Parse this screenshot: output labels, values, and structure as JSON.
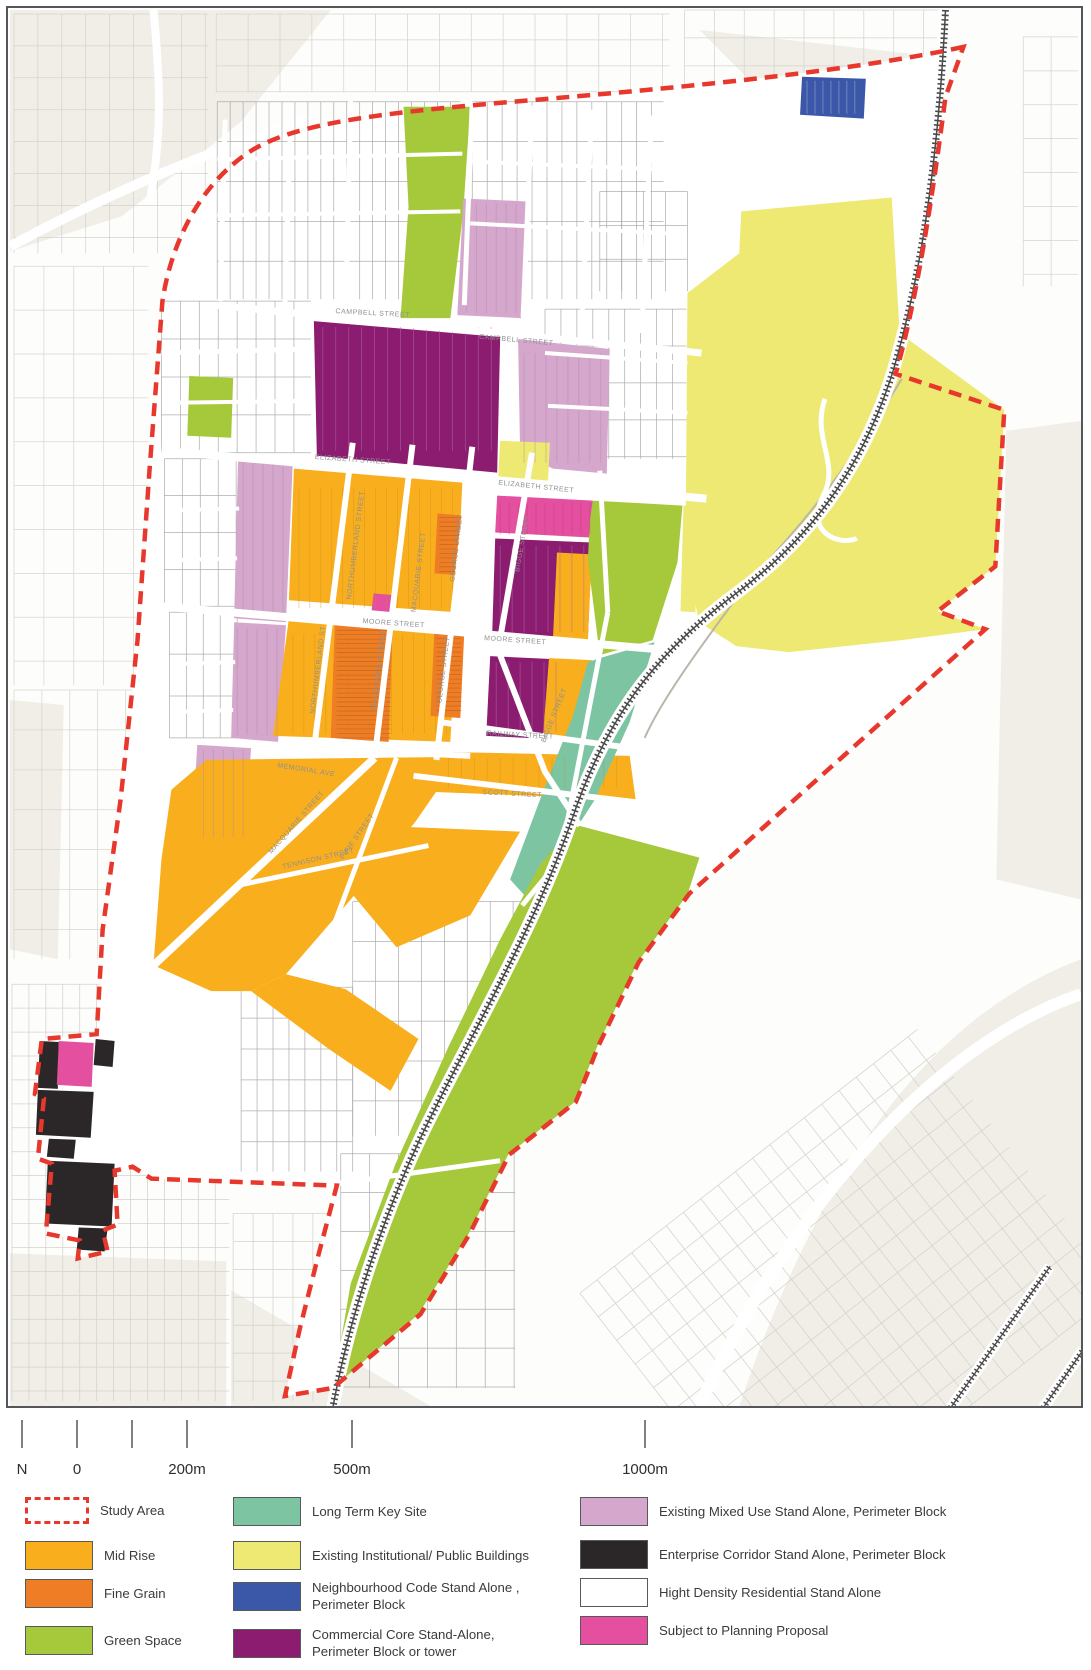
{
  "title": "Urban structure plan map with study area, zoning legend and scale bar",
  "colors": {
    "study_area_red": "#e8372c",
    "mid_rise": "#f9af1d",
    "fine_grain": "#ef7d26",
    "green_space": "#a6c93c",
    "long_term_key_site": "#7cc4a2",
    "institutional": "#ede972",
    "neighbourhood_code": "#3a57a8",
    "commercial_core": "#8b1c70",
    "mixed_use": "#d5a7cc",
    "enterprise_corridor": "#2b2728",
    "high_density_residential": "#ffffff",
    "planning_proposal": "#e44f9f",
    "railway": "#4a4a4a",
    "outside_parcel": "#d4d2cd",
    "inside_parcel": "#9c9c9c",
    "beige": "#f0eee7"
  },
  "map": {
    "street_labels": [
      {
        "text": "CAMPBELL STREET",
        "x": 372,
        "y": 314,
        "r": 3
      },
      {
        "text": "CAMPBELL STREET",
        "x": 516,
        "y": 341,
        "r": 5
      },
      {
        "text": "ELIZABETH STREET",
        "x": 352,
        "y": 461,
        "r": 4
      },
      {
        "text": "ELIZABETH STREET",
        "x": 536,
        "y": 488,
        "r": 6
      },
      {
        "text": "MOORE STREET",
        "x": 393,
        "y": 625,
        "r": 4
      },
      {
        "text": "MOORE STREET",
        "x": 515,
        "y": 642,
        "r": 4
      },
      {
        "text": "RAILWAY STREET",
        "x": 520,
        "y": 737,
        "r": 3
      },
      {
        "text": "SCOTT STREET",
        "x": 512,
        "y": 796,
        "r": 3
      },
      {
        "text": "MEMORIAL AVE",
        "x": 305,
        "y": 772,
        "r": 9
      },
      {
        "text": "NORTHUMBERLAND STREET",
        "x": 357,
        "y": 545,
        "r": -83
      },
      {
        "text": "NORTHUMBERLAND ST",
        "x": 319,
        "y": 670,
        "r": -83
      },
      {
        "text": "MACQUARIE STREET",
        "x": 420,
        "y": 572,
        "r": -83
      },
      {
        "text": "MACQUARIE STREET",
        "x": 380,
        "y": 670,
        "r": -83
      },
      {
        "text": "MACQUARIE STREET",
        "x": 297,
        "y": 824,
        "r": -49
      },
      {
        "text": "GEORGE STREET",
        "x": 458,
        "y": 548,
        "r": -83
      },
      {
        "text": "GEORGE STREET",
        "x": 445,
        "y": 670,
        "r": -83
      },
      {
        "text": "BIGGE STREET",
        "x": 524,
        "y": 543,
        "r": -80
      },
      {
        "text": "BIGGE STREET",
        "x": 556,
        "y": 716,
        "r": -68
      },
      {
        "text": "PIRIE STREET",
        "x": 358,
        "y": 838,
        "r": -55
      },
      {
        "text": "TENNISON STREET",
        "x": 318,
        "y": 861,
        "r": -13
      }
    ]
  },
  "scale_bar": {
    "ticks": [
      {
        "x": 22,
        "label": "N"
      },
      {
        "x": 77,
        "label": "0"
      },
      {
        "x": 132,
        "label": ""
      },
      {
        "x": 187,
        "label": "200m"
      },
      {
        "x": 352,
        "label": "500m"
      },
      {
        "x": 645,
        "label": "1000m"
      }
    ]
  },
  "legend": {
    "columns": [
      {
        "x": 25,
        "items": [
          {
            "y": 1497,
            "label": "Study Area",
            "type": "dashed",
            "color": "study_area_red"
          },
          {
            "y": 1541,
            "label": "Mid Rise",
            "type": "fill",
            "color": "mid_rise"
          },
          {
            "y": 1579,
            "label": "Fine Grain",
            "type": "fill",
            "color": "fine_grain"
          },
          {
            "y": 1626,
            "label": "Green Space",
            "type": "fill",
            "color": "green_space"
          }
        ]
      },
      {
        "x": 233,
        "items": [
          {
            "y": 1497,
            "label": "Long Term Key Site",
            "type": "fill",
            "color": "long_term_key_site"
          },
          {
            "y": 1541,
            "label": "Existing Institutional/ Public Buildings",
            "type": "fill",
            "color": "institutional"
          },
          {
            "y": 1579,
            "label": "Neighbourhood Code Stand Alone ,\nPerimeter Block",
            "type": "fill",
            "color": "neighbourhood_code"
          },
          {
            "y": 1626,
            "label": "Commercial Core Stand-Alone,\nPerimeter Block or tower",
            "type": "fill",
            "color": "commercial_core"
          }
        ]
      },
      {
        "x": 580,
        "items": [
          {
            "y": 1497,
            "label": "Existing Mixed Use Stand Alone, Perimeter Block",
            "type": "fill",
            "color": "mixed_use"
          },
          {
            "y": 1540,
            "label": "Enterprise Corridor Stand Alone, Perimeter Block",
            "type": "fill",
            "color": "enterprise_corridor"
          },
          {
            "y": 1578,
            "label": "Hight Density Residential Stand Alone",
            "type": "fill",
            "color": "high_density_residential"
          },
          {
            "y": 1616,
            "label": "Subject to Planning Proposal",
            "type": "fill",
            "color": "planning_proposal"
          }
        ]
      }
    ]
  }
}
